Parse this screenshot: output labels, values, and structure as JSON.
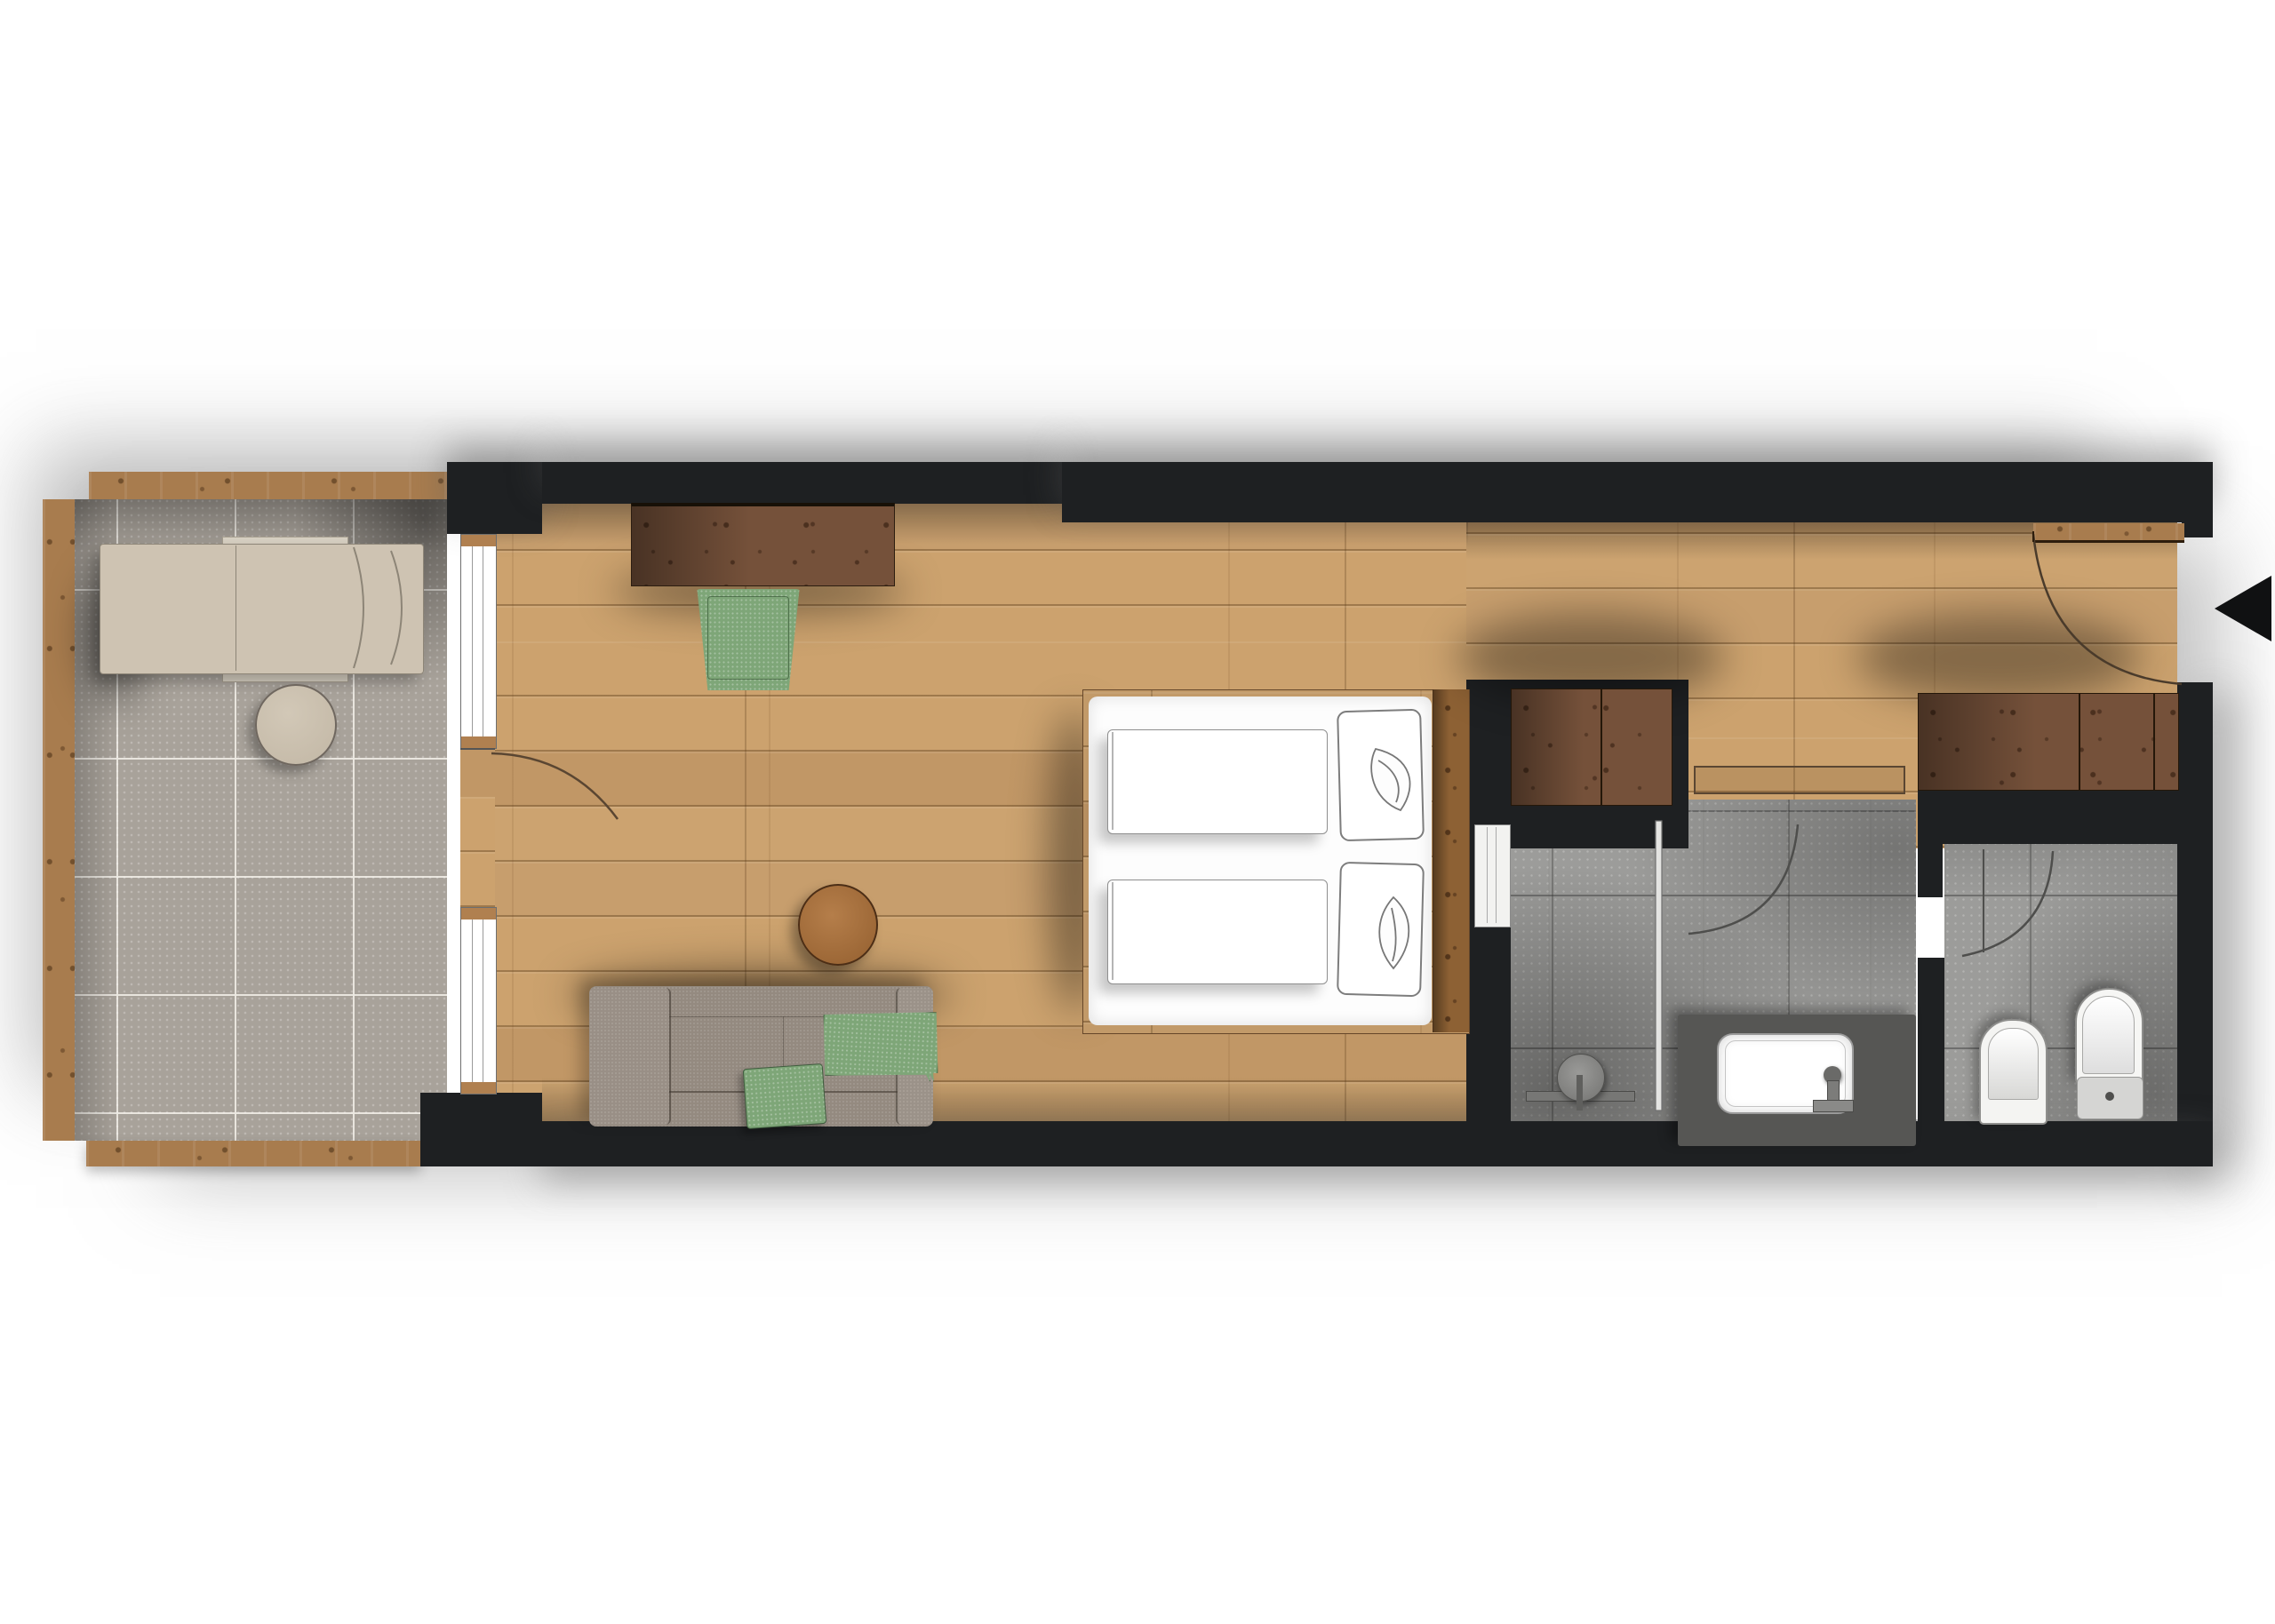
{
  "document": {
    "title": "Hotel room floor plan",
    "type": "architectural-floor-plan",
    "view": "top-down render",
    "visible_text": "none"
  },
  "palette": {
    "wall_black": "#1e2022",
    "oak_floor": "#c79e6d",
    "dark_furniture_wood": "#75513a",
    "balcony_frame_wood": "#a87c4e",
    "balcony_tile_gray": "#a8a29a",
    "bathroom_tile_gray": "#9c9c9a",
    "accent_green": "#7ea678",
    "sofa_taupe": "#948a80",
    "bedding_white": "#ffffff",
    "lounger_beige": "#cec3b2"
  },
  "rooms": {
    "balcony": {
      "label": "Balcony terrace with wood-edge frame and stone tiles"
    },
    "bedroom": {
      "label": "Living / bedroom with oak plank floor"
    },
    "hallway": {
      "label": "Entrance hallway with wardrobes"
    },
    "bathroom": {
      "label": "Bathroom with walk-in shower and vanity"
    },
    "wc": {
      "label": "Separate WC with toilet and bidet"
    }
  },
  "furniture": {
    "lounger": {
      "label": "Sun lounger"
    },
    "balcony_table": {
      "label": "Round side table"
    },
    "desk": {
      "label": "Wall-mounted desk / sideboard"
    },
    "desk_chair": {
      "label": "Green upholstered chair"
    },
    "bed": {
      "label": "Double bed with two duvets and pillows on wood platform"
    },
    "sofa": {
      "label": "Sofa with chaise, green cushion and green throw"
    },
    "coffee_table": {
      "label": "Round wooden coffee table"
    },
    "wardrobe_1": {
      "label": "Wardrobe cabinet at bed niche"
    },
    "wardrobe_2": {
      "label": "Wardrobe cabinet at entrance"
    },
    "vanity": {
      "label": "Vanity counter with washbasin"
    },
    "shower": {
      "label": "Walk-in shower with glass screen"
    },
    "toilet": {
      "label": "Toilet"
    },
    "bidet": {
      "label": "Bidet"
    }
  },
  "openings": {
    "entrance": {
      "label": "Entrance door, swings inward, marked with black arrow"
    },
    "balcony_door": {
      "label": "Balcony door between two windows"
    },
    "bathroom_door": {
      "label": "Bathroom swing door"
    },
    "wc_door": {
      "label": "WC swing door"
    },
    "sliding_door": {
      "label": "Sliding door bedroom to bathroom"
    },
    "windows": {
      "label": "Two floor-to-ceiling windows to balcony"
    }
  }
}
